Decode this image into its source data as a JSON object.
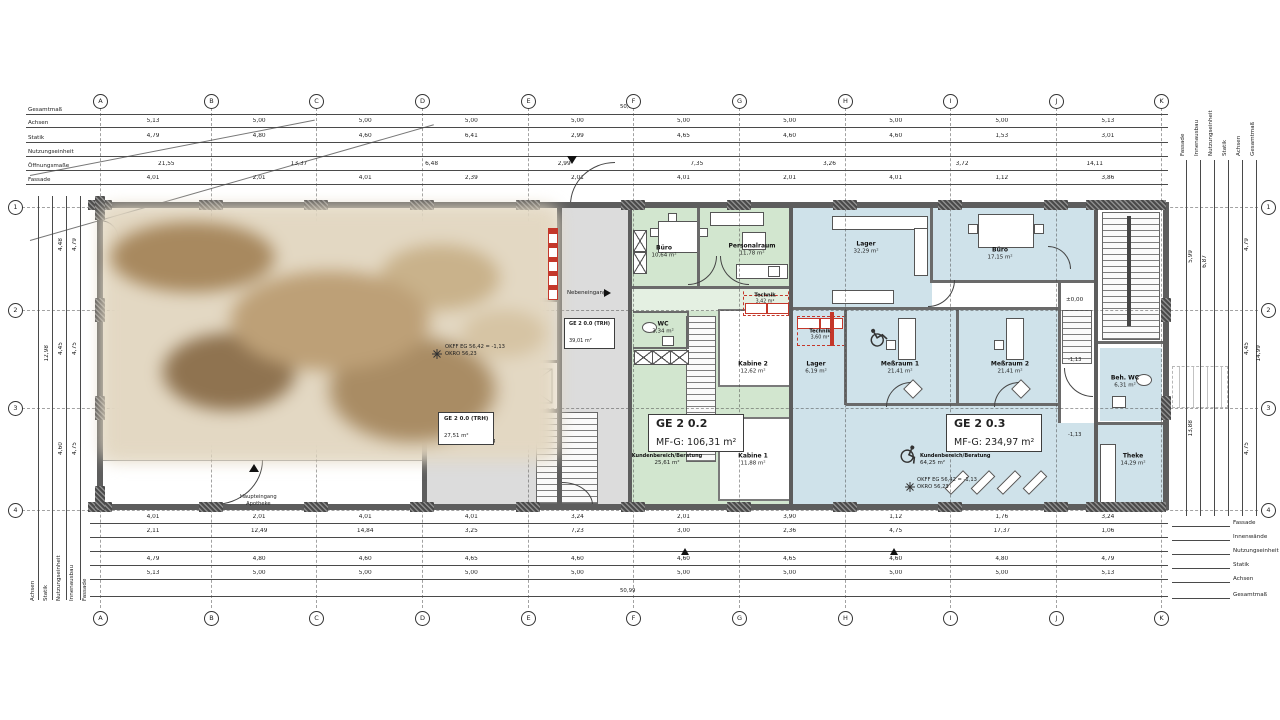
{
  "colors": {
    "unit_green": "#d2e6cf",
    "unit_blue": "#cfe2ea",
    "circulation_gray": "#dcdcdc",
    "wall_gray": "#5d5d5d",
    "accent_red": "#c4372a"
  },
  "grid": {
    "columns": [
      "A",
      "B",
      "C",
      "D",
      "E",
      "F",
      "G",
      "H",
      "I",
      "J",
      "K"
    ],
    "rows": [
      "1",
      "2",
      "3",
      "4"
    ]
  },
  "totals": {
    "overall_width": "50,99"
  },
  "chains": {
    "top_left_labels": [
      "Gesamtmaß",
      "Achsen",
      "Statik",
      "Nutzungseinheit",
      "Öffnungsmaße",
      "Fassade"
    ],
    "top_right_labels": [
      "Fassade",
      "Innenausbau",
      "Nutzungseinheit",
      "Statik",
      "Achsen",
      "Gesamtmaß"
    ],
    "bottom_left_labels": [
      "Achsen",
      "Statik",
      "Nutzungseinheit",
      "Innenausbau",
      "Fassade"
    ],
    "bottom_right_labels": [
      "Fassade",
      "Innenwände",
      "Nutzungseinheit",
      "Statik",
      "Achsen",
      "Gesamtmaß"
    ],
    "axes_top": [
      "5,13",
      "5,00",
      "5,00",
      "5,00",
      "5,00",
      "5,00",
      "5,00",
      "5,00",
      "5,00",
      "5,13"
    ],
    "statik_top": [
      "4,79",
      "4,80",
      "4,60",
      "6,41",
      "2,99",
      "4,65",
      "4,60",
      "4,60",
      "1,53",
      "3,01"
    ],
    "oeffnung_top": [
      "21,55",
      "13,37",
      "6,48",
      "2,99",
      "7,35",
      "3,26",
      "3,72",
      "14,11"
    ],
    "fassade_top": [
      "4,01",
      "2,01",
      "4,01",
      "2,39",
      "2,01",
      "4,01",
      "2,01",
      "4,01",
      "1,12",
      "3,86"
    ],
    "fassade_bottom": [
      "4,01",
      "2,01",
      "4,01",
      "4,01",
      "3,24",
      "2,01",
      "3,90",
      "1,12",
      "1,76",
      "3,24"
    ],
    "innen_bottom": [
      "2,11",
      "12,49",
      "14,84",
      "3,25",
      "7,23",
      "3,00",
      "2,36",
      "4,75",
      "17,37",
      "1,06"
    ],
    "statik_bottom": [
      "4,79",
      "4,80",
      "4,60",
      "4,65",
      "4,60",
      "4,60",
      "4,65",
      "4,60",
      "4,80",
      "4,79"
    ],
    "axes_bottom": [
      "5,13",
      "5,00",
      "5,00",
      "5,00",
      "5,00",
      "5,00",
      "5,00",
      "5,00",
      "5,00",
      "5,13"
    ],
    "rows_left": [
      "4,79",
      "4,75",
      "4,75"
    ],
    "left_inner": [
      "4,48",
      "4,45",
      "4,60"
    ],
    "left_total": "12,98",
    "rows_right": [
      "4,79",
      "4,45",
      "4,75"
    ],
    "right_inner": [
      "5,99",
      "6,87",
      "13,88"
    ],
    "right_total": "14,99"
  },
  "units": {
    "trh1": {
      "name": "GE 2 0.0 (TRH)",
      "area": "39,01 m²"
    },
    "trh2": {
      "name": "GE 2 0.0 (TRH)",
      "area": "27,51 m²"
    },
    "ge202": {
      "name": "GE 2 0.2",
      "area": "MF-G: 106,31 m²"
    },
    "ge203": {
      "name": "GE 2 0.3",
      "area": "MF-G: 234,97 m²"
    }
  },
  "rooms": {
    "buero_g": {
      "name": "Büro",
      "area": "10,64 m²"
    },
    "personalraum": {
      "name": "Personalraum",
      "area": "11,78 m²"
    },
    "technik_g": {
      "name": "Technik",
      "area": "3,42 m²"
    },
    "wc": {
      "name": "WC",
      "area": "3,34 m²"
    },
    "kabine2": {
      "name": "Kabine 2",
      "area": "12,62 m²"
    },
    "kabine1": {
      "name": "Kabine 1",
      "area": "11,88 m²"
    },
    "kunden_g": {
      "name": "Kundenbereich/Beratung",
      "area": "25,61 m²"
    },
    "lager1": {
      "name": "Lager",
      "area": "32,29 m²"
    },
    "buero_b": {
      "name": "Büro",
      "area": "17,15 m²"
    },
    "technik_b": {
      "name": "Technik",
      "area": "3,60 m²"
    },
    "lager2": {
      "name": "Lager",
      "area": "6,19 m²"
    },
    "messraum1": {
      "name": "Meßraum 1",
      "area": "21,41 m²"
    },
    "messraum2": {
      "name": "Meßraum 2",
      "area": "21,41 m²"
    },
    "kunden_b": {
      "name": "Kundenbereich/Beratung",
      "area": "64,25 m²"
    },
    "theke": {
      "name": "Theke",
      "area": "14,29 m²"
    },
    "behwc": {
      "name": "Beh. WC",
      "area": "6,31 m²"
    }
  },
  "annotations": {
    "nebeneingang": "Nebeneingang",
    "haupteingang_line1": "Haupteingang",
    "haupteingang_line2": "Apotheke",
    "level_zero": "±0,00",
    "level_minus": "-1,13",
    "okff": "OKFF EG 56,42 = -1,13",
    "okro": "OKRO 56,23"
  }
}
